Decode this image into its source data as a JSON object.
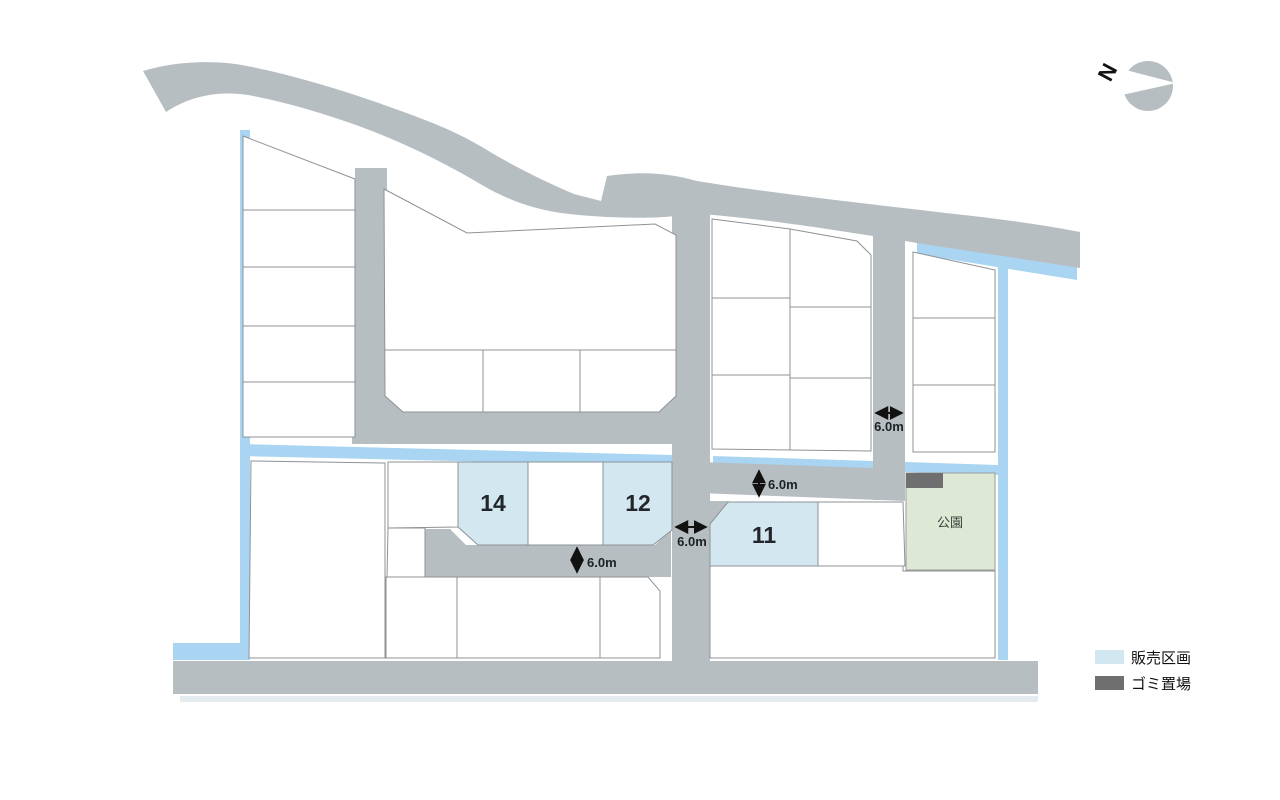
{
  "map": {
    "sale_lots": [
      {
        "id": "lot14",
        "number": "14"
      },
      {
        "id": "lot12",
        "number": "12"
      },
      {
        "id": "lot11",
        "number": "11"
      }
    ],
    "park": {
      "label": "公園"
    },
    "dimensions": {
      "d0": "6.0m",
      "d1": "6.0m",
      "d2": "6.0m",
      "d3": "6.0m"
    },
    "compass": {
      "north": "N"
    }
  },
  "legend": {
    "items": [
      {
        "label": "販売区画",
        "color": "#d2e7f0"
      },
      {
        "label": "ゴミ置場",
        "color": "#6f6f6f"
      }
    ]
  },
  "colors": {
    "road": "#b7bec2",
    "water": "#a9d5f2",
    "park": "#dde9d5",
    "sale_lot": "#d2e7f0",
    "garbage": "#6f6f6f",
    "lot_stroke": "#8d9296",
    "text": "#1d2124"
  }
}
